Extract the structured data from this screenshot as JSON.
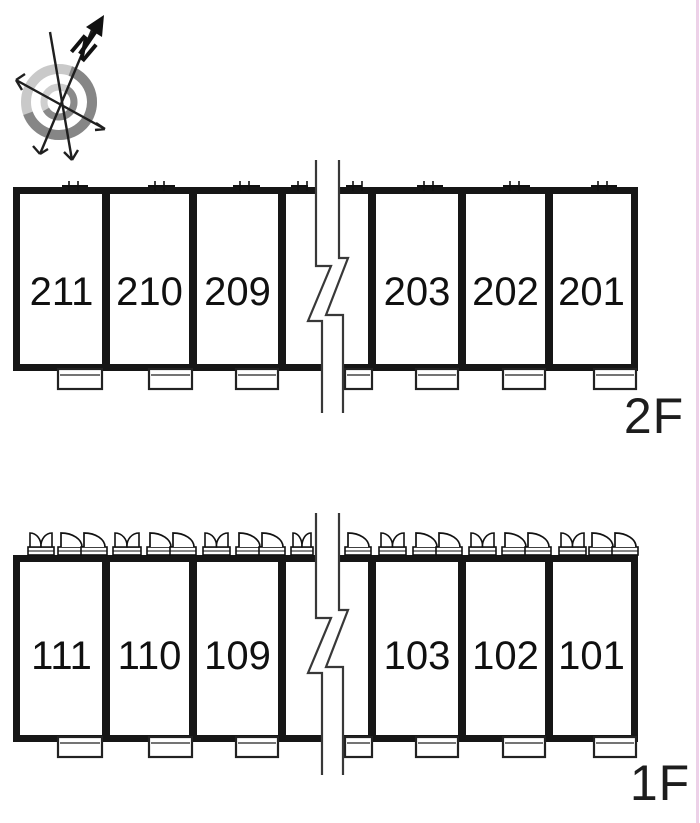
{
  "compass": {
    "north_label": "N"
  },
  "floors": [
    {
      "id": "2f",
      "label": "2F",
      "rooms": [
        "211",
        "210",
        "209",
        "203",
        "202",
        "201"
      ]
    },
    {
      "id": "1f",
      "label": "1F",
      "rooms": [
        "111",
        "110",
        "109",
        "103",
        "102",
        "101"
      ]
    }
  ]
}
